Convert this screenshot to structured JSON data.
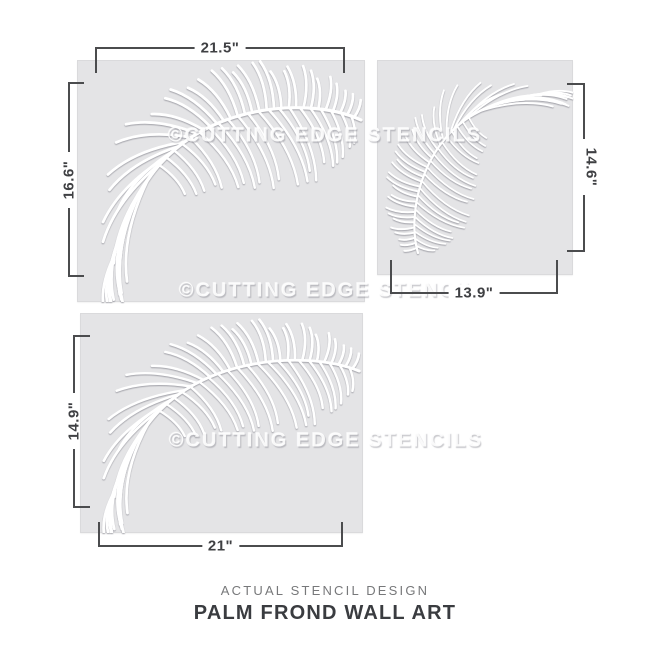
{
  "watermark_text": "©CUTTING EDGE STENCILS",
  "stencils": [
    {
      "name": "large-arching-frond",
      "width_label": "21.5\"",
      "height_label": "16.6\""
    },
    {
      "name": "small-drooping-frond",
      "width_label": "13.9\"",
      "height_label": "14.6\""
    },
    {
      "name": "wide-arching-frond",
      "width_label": "21\"",
      "height_label": "14.9\""
    }
  ],
  "caption": {
    "subtitle": "ACTUAL STENCIL DESIGN",
    "title": "PALM FROND WALL ART"
  },
  "colors": {
    "page_background": "#ffffff",
    "stencil_background": "#e4e4e6",
    "frond_stroke": "#ffffff",
    "dimension_line": "#4b4c4e",
    "dimension_text": "#3f4043",
    "watermark_text_color": "rgba(255,255,255,0.88)",
    "subtitle_text": "#77787a",
    "title_text": "#3a3c40"
  }
}
